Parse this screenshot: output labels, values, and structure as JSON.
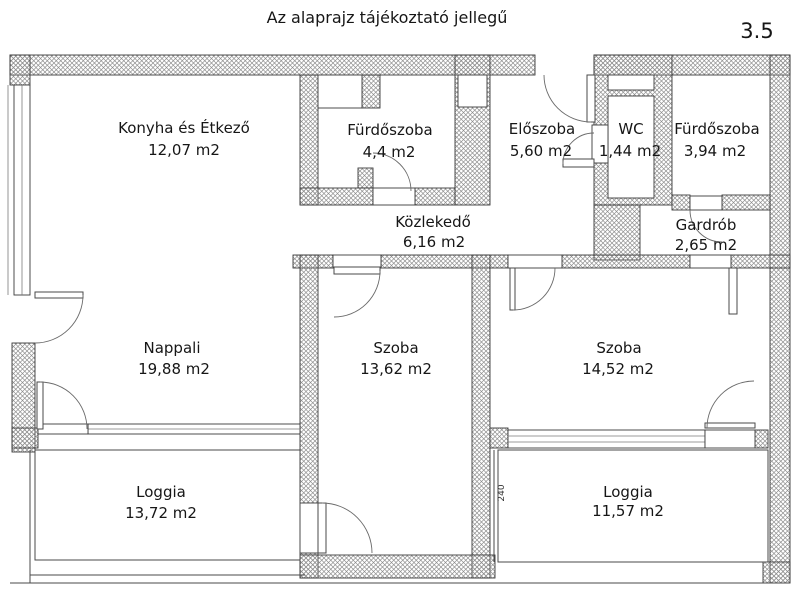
{
  "header": {
    "title": "Az alaprajz tájékoztató jellegű",
    "plan_number": "3.5"
  },
  "rooms": [
    {
      "id": "konyha",
      "name": "Konyha és Étkező",
      "area": "12,07 m2"
    },
    {
      "id": "furdoszoba1",
      "name": "Fürdőszoba",
      "area": "4,4 m2"
    },
    {
      "id": "eloszoba",
      "name": "Előszoba",
      "area": "5,60 m2"
    },
    {
      "id": "wc",
      "name": "WC",
      "area": "1,44 m2"
    },
    {
      "id": "furdoszoba2",
      "name": "Fürdőszoba",
      "area": "3,94 m2"
    },
    {
      "id": "kozlekedo",
      "name": "Közlekedő",
      "area": "6,16 m2"
    },
    {
      "id": "gardrob",
      "name": "Gardrób",
      "area": "2,65 m2"
    },
    {
      "id": "nappali",
      "name": "Nappali",
      "area": "19,88 m2"
    },
    {
      "id": "szoba1",
      "name": "Szoba",
      "area": "13,62 m2"
    },
    {
      "id": "szoba2",
      "name": "Szoba",
      "area": "14,52 m2"
    },
    {
      "id": "loggia1",
      "name": "Loggia",
      "area": "13,72 m2"
    },
    {
      "id": "loggia2",
      "name": "Loggia",
      "area": "11,57 m2"
    }
  ],
  "dimensions": {
    "loggia_depth": "240"
  },
  "colors": {
    "background": "#ffffff",
    "wall_hatch": "#8b8b8b",
    "line": "#3a3a3a",
    "text": "#161616"
  }
}
